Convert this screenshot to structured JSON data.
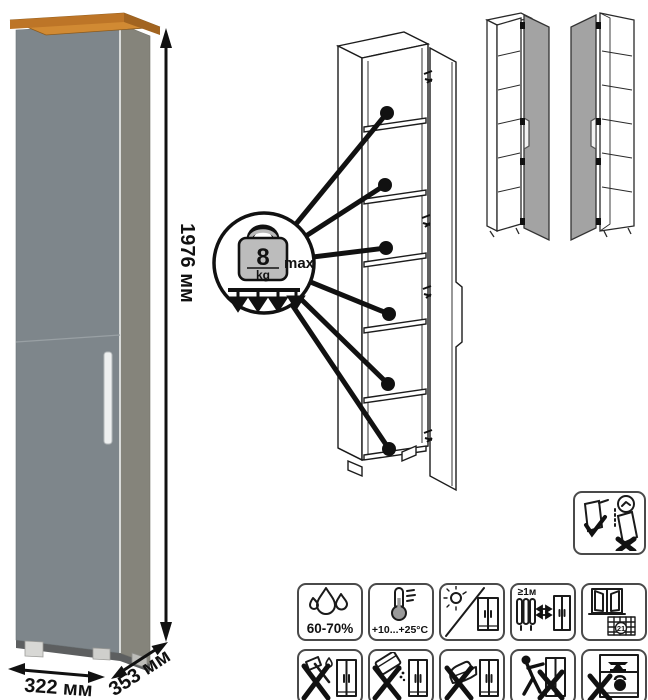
{
  "dimensions": {
    "height": "1976 мм",
    "width": "322 мм",
    "depth": "353 мм"
  },
  "load": {
    "value": "8",
    "unit": "kg",
    "qualifier": "max"
  },
  "care": {
    "humidity": "60-70%",
    "temperature": "+10...+25°C",
    "min_distance": "≥1м",
    "acclimatization_days": "21"
  },
  "colors": {
    "door_front": "#7E868B",
    "side_panel": "#85847B",
    "wood_top": "#C9822F",
    "drawing_gray_door": "#A3A3A3"
  },
  "icons": {
    "standalone": "wall-anchoring-required",
    "row1": [
      "humidity-60-70",
      "temperature-range",
      "no-direct-sunlight",
      "keep-1m-from-heat",
      "ventilate-21-days"
    ],
    "row2": [
      "no-sharp-impacts",
      "no-aggressive-cleaners",
      "no-hot-objects",
      "no-dragging",
      "no-overloading"
    ]
  }
}
